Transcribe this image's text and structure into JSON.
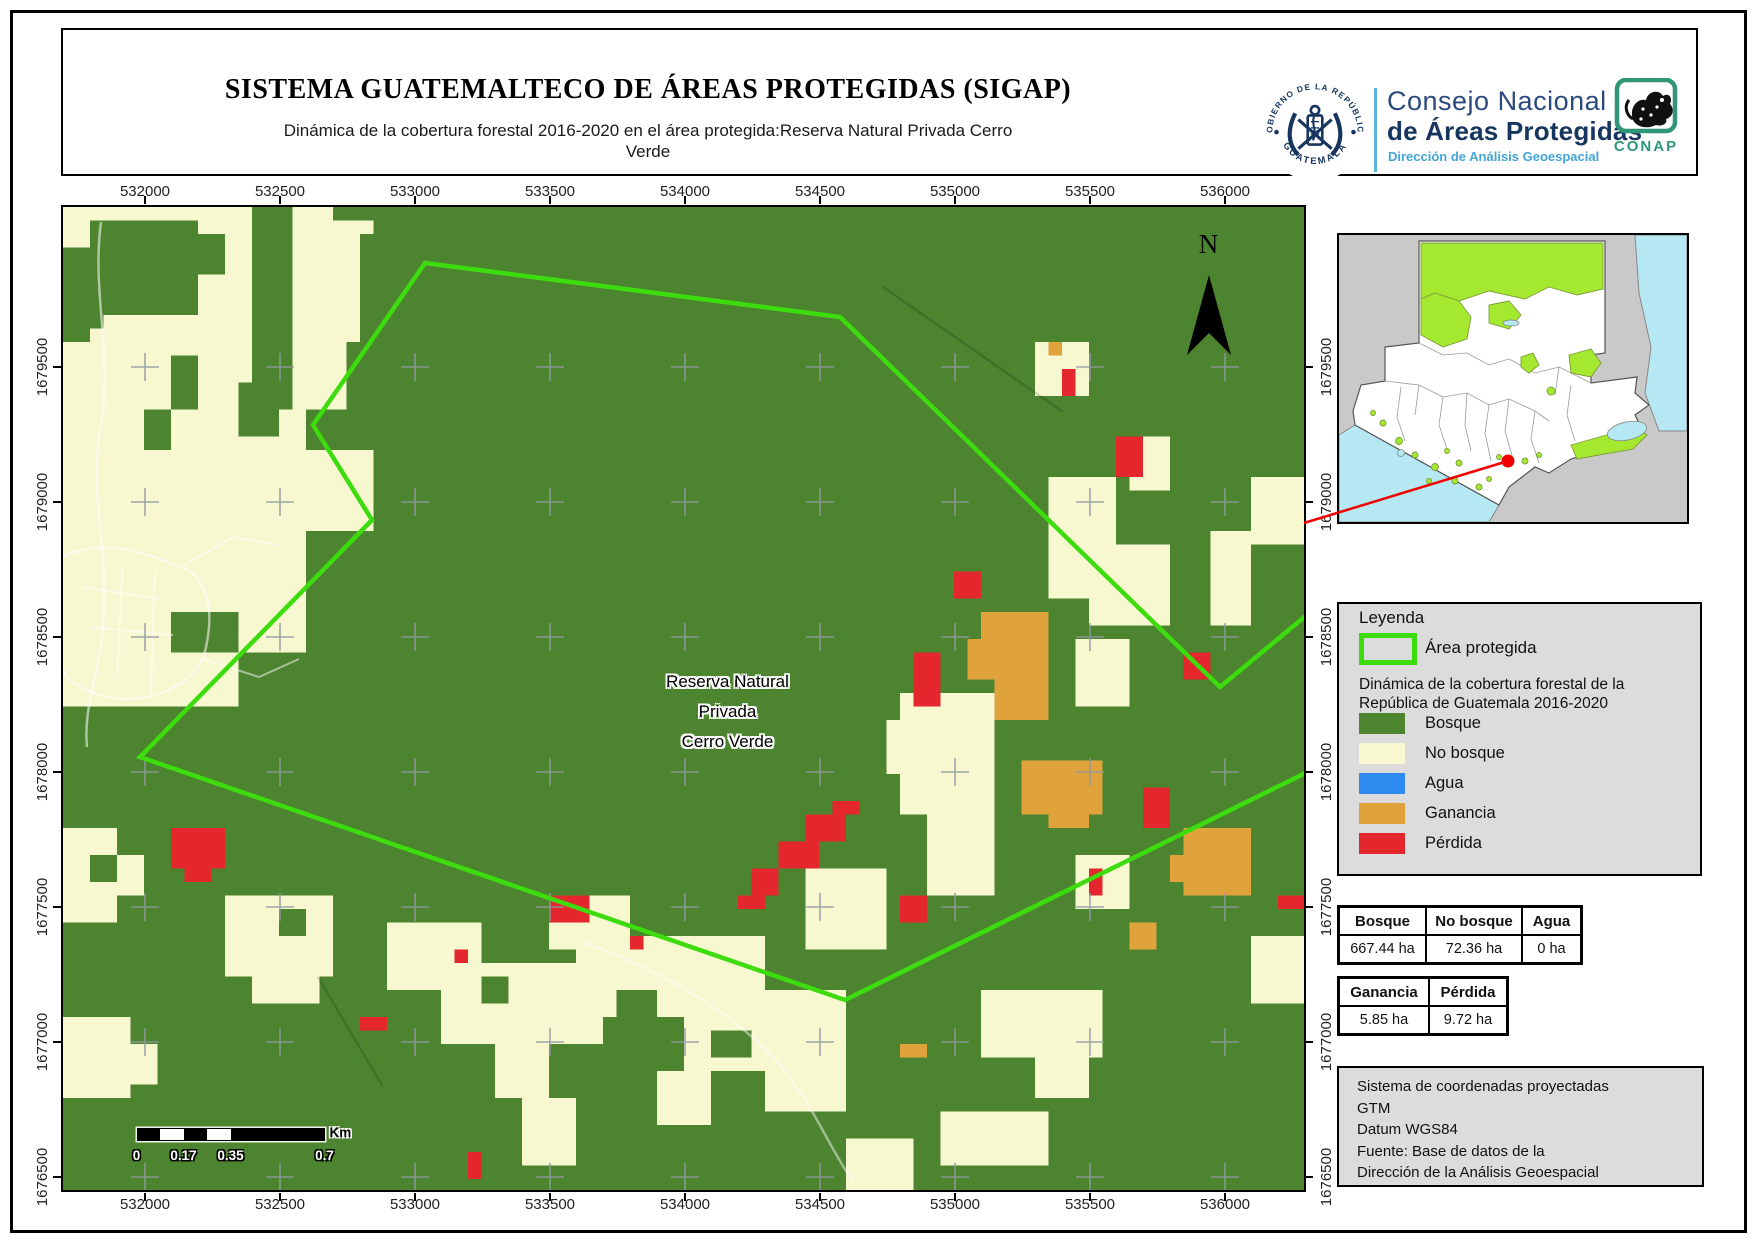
{
  "page": {
    "title": "SISTEMA GUATEMALTECO DE ÁREAS PROTEGIDAS  (SIGAP)",
    "subtitle": "Dinámica de la cobertura forestal 2016-2020 en el área protegida:Reserva Natural Privada Cerro Verde"
  },
  "branding": {
    "emblem_top": "GOBIERNO DE LA REPÚBLICA",
    "emblem_bottom": "GUATEMALA",
    "org_line1": "Consejo Nacional",
    "org_line2": "de Áreas Protegidas",
    "org_line3": "Dirección de Análisis Geoespacial",
    "conap": "CONAP"
  },
  "map": {
    "north_label": "N",
    "area_label_lines": [
      "Reserva Natural",
      "Privada",
      "Cerro Verde"
    ],
    "x_ticks": [
      "532000",
      "532500",
      "533000",
      "533500",
      "534000",
      "534500",
      "535000",
      "535500",
      "536000"
    ],
    "y_ticks": [
      "1679500",
      "1679000",
      "1678500",
      "1678000",
      "1677500",
      "1677000",
      "1676500"
    ]
  },
  "scalebar": {
    "labels": [
      "0",
      "0.17",
      "0.35",
      "0.7"
    ],
    "unit": "Km"
  },
  "legend": {
    "title": "Leyenda",
    "protected_label": "Área protegida",
    "dynamics_lines": [
      "Dinámica de la cobertura forestal de la",
      "República de Guatemala 2016-2020"
    ],
    "classes": [
      {
        "label": "Bosque",
        "color": "#4d8430"
      },
      {
        "label": "No bosque",
        "color": "#f7f7d0"
      },
      {
        "label": "Agua",
        "color": "#2e8cf0"
      },
      {
        "label": "Ganancia",
        "color": "#e0a33c"
      },
      {
        "label": "Pérdida",
        "color": "#e3272c"
      }
    ]
  },
  "tables": [
    {
      "headers": [
        "Bosque",
        "No bosque",
        "Agua"
      ],
      "values": [
        "667.44 ha",
        "72.36 ha",
        "0 ha"
      ]
    },
    {
      "headers": [
        "Ganancia",
        "Pérdida"
      ],
      "values": [
        "5.85 ha",
        "9.72 ha"
      ]
    }
  ],
  "projection": {
    "lines": [
      "Sistema de coordenadas proyectadas",
      "GTM",
      "Datum WGS84",
      "Fuente: Base de datos de la",
      "Dirección de la Análisis Geoespacial"
    ]
  },
  "colors": {
    "forest": "#4d8430",
    "no_forest": "#f7f7d0",
    "water": "#2e8cf0",
    "gain": "#e0a33c",
    "loss": "#e3272c",
    "boundary": "#3ddc0f",
    "inset_lime": "#a4e82f",
    "inset_water": "#b5e8f3",
    "inset_land": "#ffffff",
    "inset_bg": "#c9c9c9",
    "panel": "#dcdcdc",
    "navy": "#16355f",
    "teal": "#2f9678",
    "lightblue": "#44a5d6",
    "locator_red": "#f00000"
  }
}
